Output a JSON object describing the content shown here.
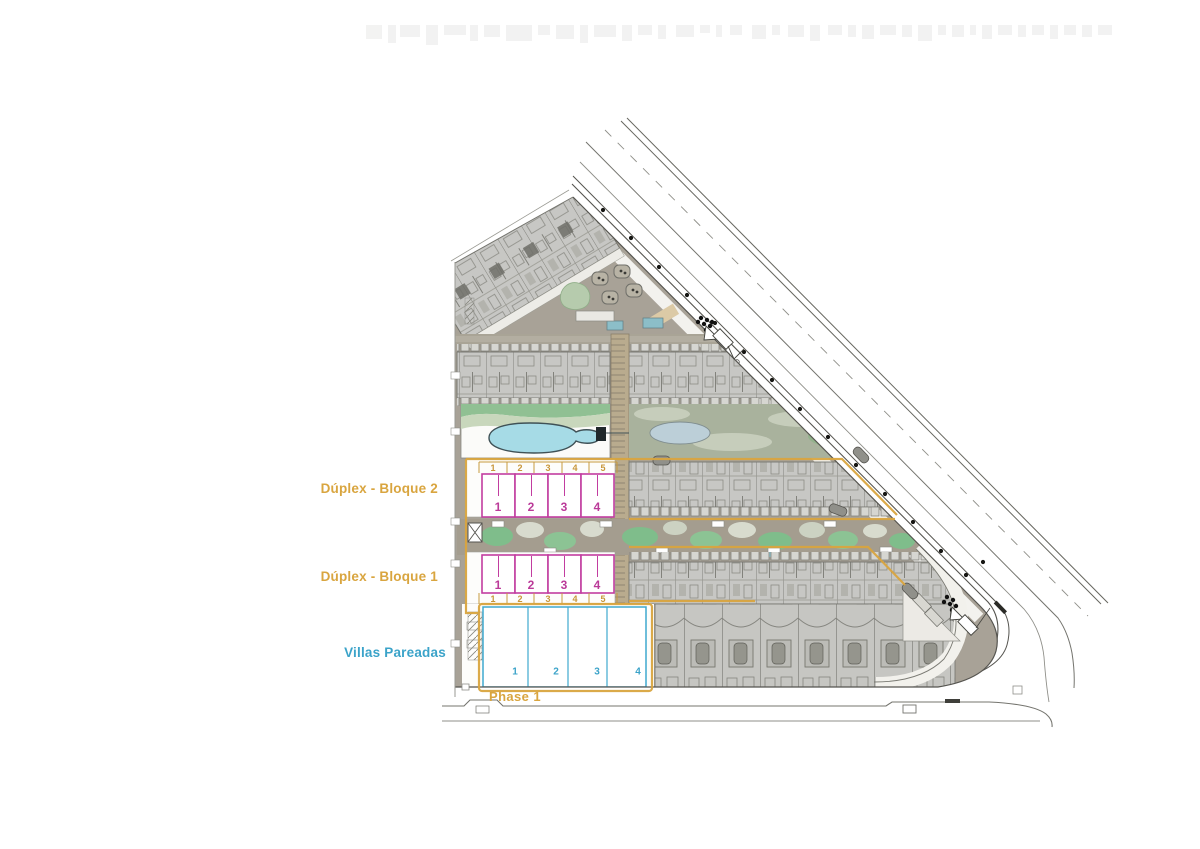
{
  "plan": {
    "labels": {
      "bloque2": "Dúplex - Bloque 2",
      "bloque1": "Dúplex - Bloque 1",
      "villas": "Villas Pareadas",
      "phase": "Phase 1"
    },
    "bloque2": {
      "plot_numbers": [
        "1",
        "2",
        "3",
        "4",
        "5"
      ],
      "unit_numbers": [
        "1",
        "2",
        "3",
        "4"
      ]
    },
    "bloque1": {
      "plot_numbers": [
        "1",
        "2",
        "3",
        "4",
        "5"
      ],
      "unit_numbers": [
        "1",
        "2",
        "3",
        "4"
      ]
    },
    "villas": {
      "unit_numbers": [
        "1",
        "2",
        "3",
        "4"
      ]
    },
    "colors": {
      "phase_accent": "#D9A53F",
      "duplex_outline": "#BB3A99",
      "villas_accent": "#3BA3C9",
      "site_fill": "#A8A297",
      "building_fill": "#C7C7C4",
      "pool_blue": "#A6DBE6",
      "landscape_green": "#7FBD8B"
    }
  }
}
